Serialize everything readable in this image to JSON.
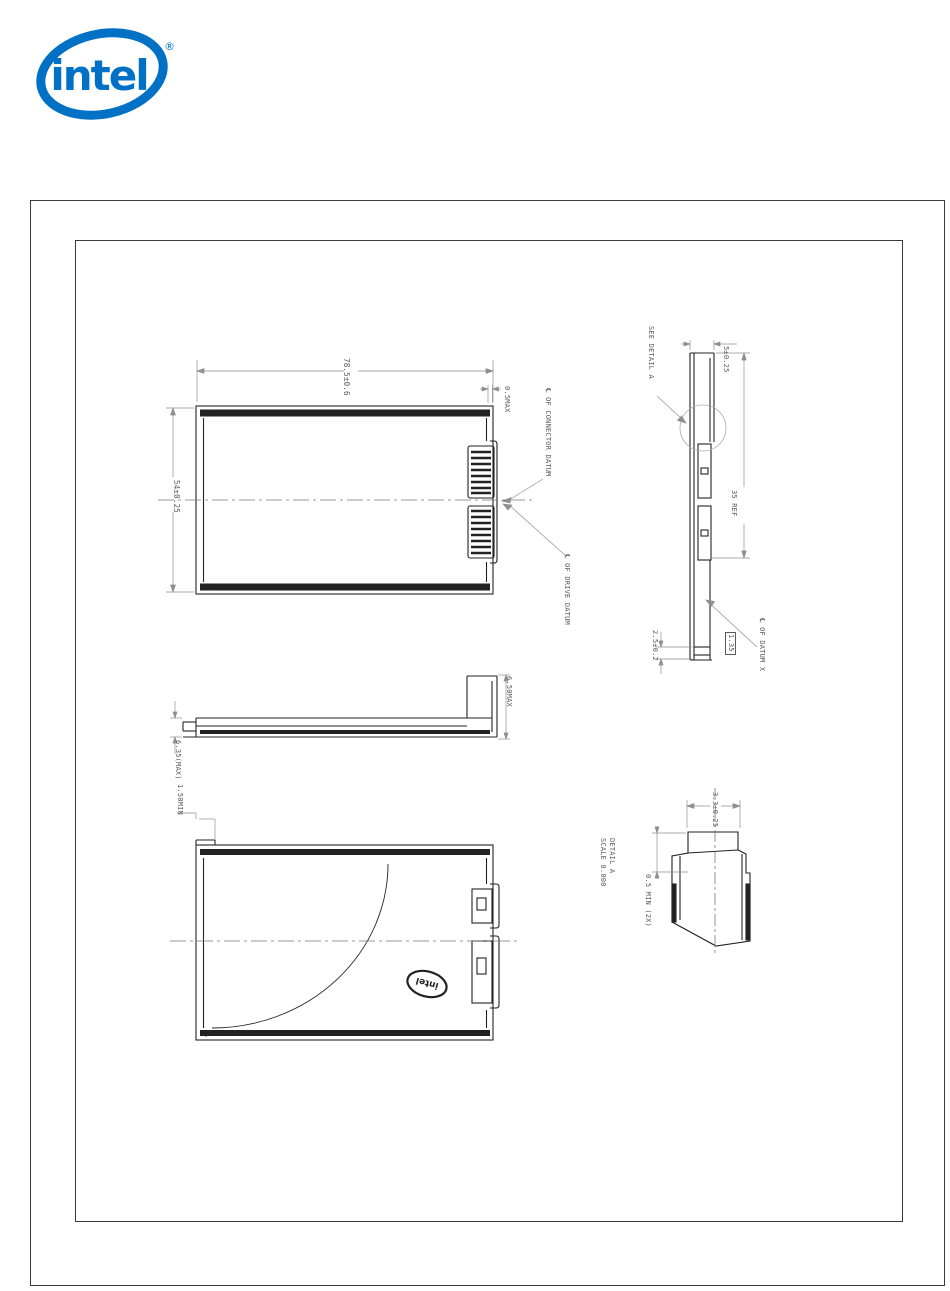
{
  "branding": {
    "logo_text": "intel",
    "registered_mark": "®",
    "brand_color": "#0071c5"
  },
  "drawing": {
    "line_color": "#222222",
    "dim_color": "#8f8f8f",
    "top_view": {
      "dim_width": "78.5±0.6",
      "dim_height": "54±0.25",
      "dim_lip": "0.5MAX",
      "label_connector_datum": "℄ OF CONNECTOR DATUM",
      "label_drive_datum": "℄ OF DRIVE DATUM"
    },
    "side_view": {
      "label_see_detail": "SEE DETAIL A",
      "dim_thickness": "5±0.25",
      "dim_ref": "35 REF",
      "dim_pad": "2.5±0.2",
      "dim_basic_boxed": "1.35",
      "label_datum_x": "℄ OF DATUM X"
    },
    "profile_view": {
      "dim_left": "6.35(MAX)",
      "dim_right": "6.50MAX"
    },
    "bottom_view": {
      "dim_step": "1.50MIN",
      "logo_text": "intel"
    },
    "detail_a": {
      "title": "DETAIL A",
      "scale": "SCALE 8.000",
      "dim_width": "3.3±0.25",
      "dim_min": "0.5 MIN (2X)"
    }
  }
}
